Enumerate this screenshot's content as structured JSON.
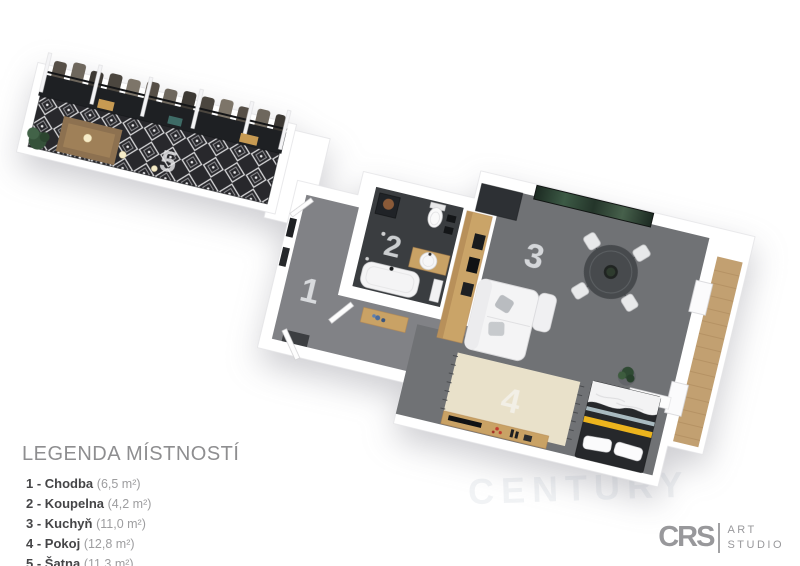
{
  "legend": {
    "title": "LEGENDA MÍSTNOSTÍ",
    "items": [
      {
        "label": "1 - Chodba",
        "area": "(6,5 m²)"
      },
      {
        "label": "2 - Koupelna",
        "area": "(4,2 m²)"
      },
      {
        "label": "3 - Kuchyň",
        "area": "(11,0 m²)"
      },
      {
        "label": "4 - Pokoj",
        "area": "(12,8 m²)"
      },
      {
        "label": "5 - Šatna",
        "area": "(11,3 m²)"
      }
    ],
    "footnote": "*Plocha místností je pouze orientační"
  },
  "plan": {
    "room_numbers": [
      "1",
      "2",
      "3",
      "4",
      "5"
    ],
    "room_names": [
      "Chodba",
      "Koupelna",
      "Kuchyň",
      "Pokoj",
      "Šatna"
    ],
    "colors": {
      "wall_white": "#ffffff",
      "floor_hall_gray": "#818286",
      "floor_living_gray": "#707275",
      "floor_bath_dark": "#3a3d40",
      "wardrobe_floor_dark": "#28282c",
      "rug_beige": "#e9e1ca",
      "wood": "#c9a265",
      "balcony_wood": "#c2a071",
      "bed_dark": "#26282b",
      "bed_stripe_yellow": "#ecb41d",
      "artwork_green": "#3c5a45"
    }
  },
  "watermark": "CENTURY",
  "logo": {
    "brand": "CRS",
    "line1": "ART",
    "line2": "STUDIO"
  }
}
